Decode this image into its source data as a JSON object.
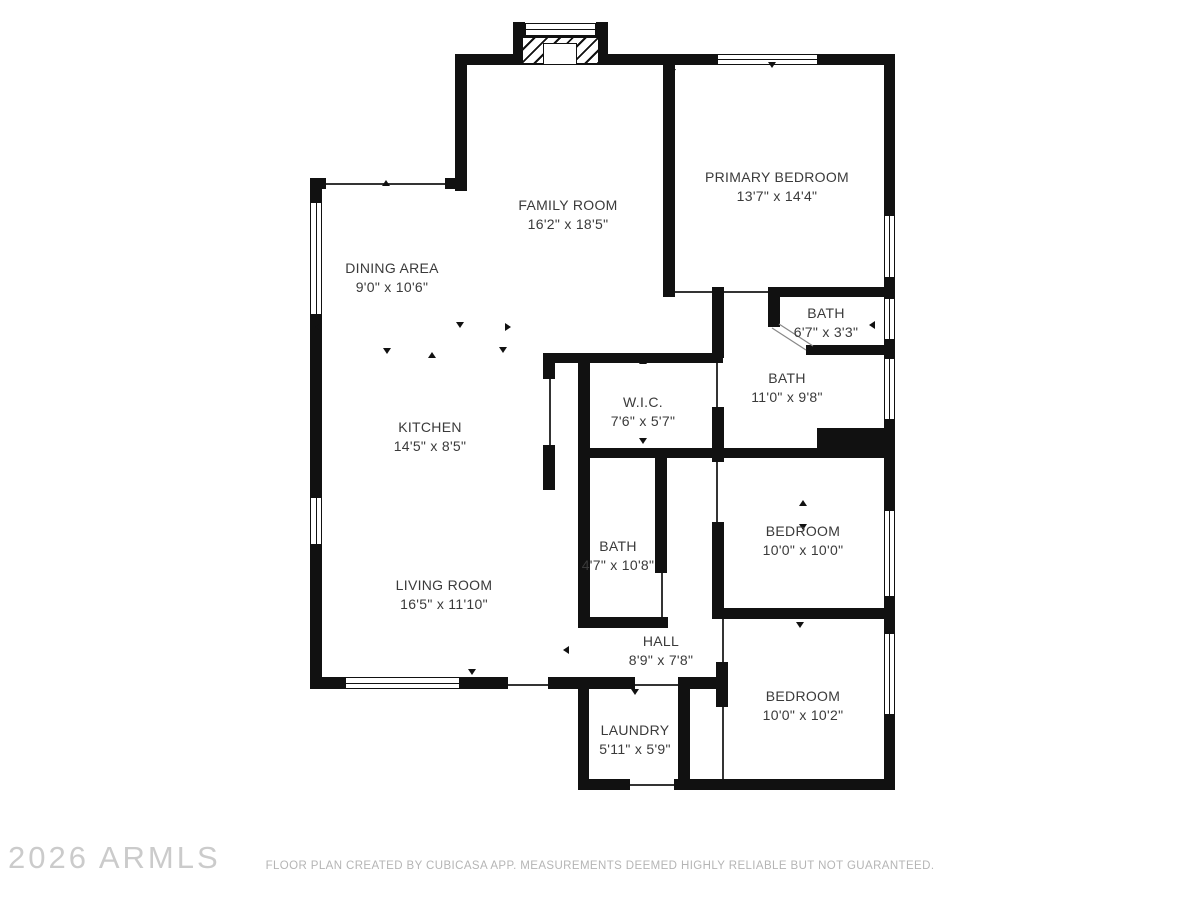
{
  "plan": {
    "rooms": [
      {
        "id": "family-room",
        "name": "FAMILY ROOM",
        "dims": "16'2\" x 18'5\""
      },
      {
        "id": "primary-bedroom",
        "name": "PRIMARY BEDROOM",
        "dims": "13'7\" x 14'4\""
      },
      {
        "id": "dining-area",
        "name": "DINING AREA",
        "dims": "9'0\" x 10'6\""
      },
      {
        "id": "bath-small",
        "name": "BATH",
        "dims": "6'7\" x 3'3\""
      },
      {
        "id": "bath-large",
        "name": "BATH",
        "dims": "11'0\" x 9'8\""
      },
      {
        "id": "wic",
        "name": "W.I.C.",
        "dims": "7'6\" x 5'7\""
      },
      {
        "id": "kitchen",
        "name": "KITCHEN",
        "dims": "14'5\" x 8'5\""
      },
      {
        "id": "bedroom-1",
        "name": "BEDROOM",
        "dims": "10'0\" x 10'0\""
      },
      {
        "id": "bath-hall",
        "name": "BATH",
        "dims": "4'7\" x 10'8\""
      },
      {
        "id": "living-room",
        "name": "LIVING ROOM",
        "dims": "16'5\" x 11'10\""
      },
      {
        "id": "hall",
        "name": "HALL",
        "dims": "8'9\" x 7'8\""
      },
      {
        "id": "bedroom-2",
        "name": "BEDROOM",
        "dims": "10'0\" x 10'2\""
      },
      {
        "id": "laundry",
        "name": "LAUNDRY",
        "dims": "5'11\" x 5'9\""
      }
    ],
    "watermark": "2026 ARMLS",
    "footer": "FLOOR PLAN CREATED BY CUBICASA APP. MEASUREMENTS DEEMED HIGHLY RELIABLE BUT NOT GUARANTEED."
  },
  "colors": {
    "wall": "#111111",
    "label": "#3a3a3a",
    "muted": "#b5b5b5",
    "watermark": "#cbcbcb"
  }
}
